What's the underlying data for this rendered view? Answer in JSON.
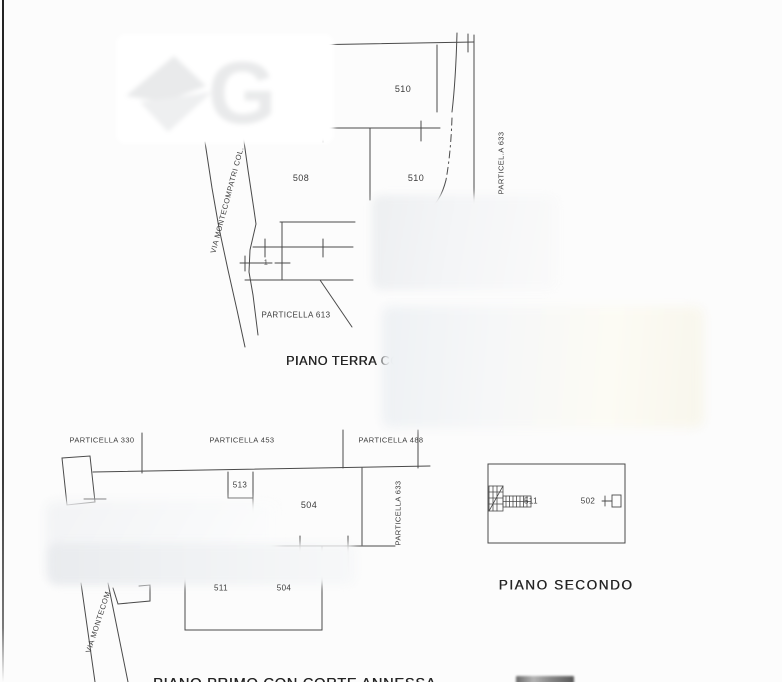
{
  "watermark": {
    "letter": "G"
  },
  "piano_terra": {
    "title": "PIANO TERRA CO",
    "road_label": "VIA MONTECOMPATRI COL.",
    "boundary_label_right": "PARTICEL.A 633",
    "boundary_label_bottom": "PARTICELLA 613",
    "room_510_top": "510",
    "room_508": "508",
    "room_510_lower": "510",
    "room_1": "1"
  },
  "piano_primo": {
    "title": "PIANO PRIMO CON CORTE ANNESSA",
    "road_label": "VIA MONTECOM",
    "boundary_label_330": "PARTICELLA 330",
    "boundary_label_453": "PARTICELLA 453",
    "boundary_label_488": "PARTICELLA 488",
    "boundary_label_633": "PARTICELLA 633",
    "room_513": "513",
    "room_504_upper": "504",
    "room_511": "511",
    "room_504_lower": "504"
  },
  "piano_secondo": {
    "title": "PIANO SECONDO",
    "room_511": "511",
    "room_502": "502"
  }
}
